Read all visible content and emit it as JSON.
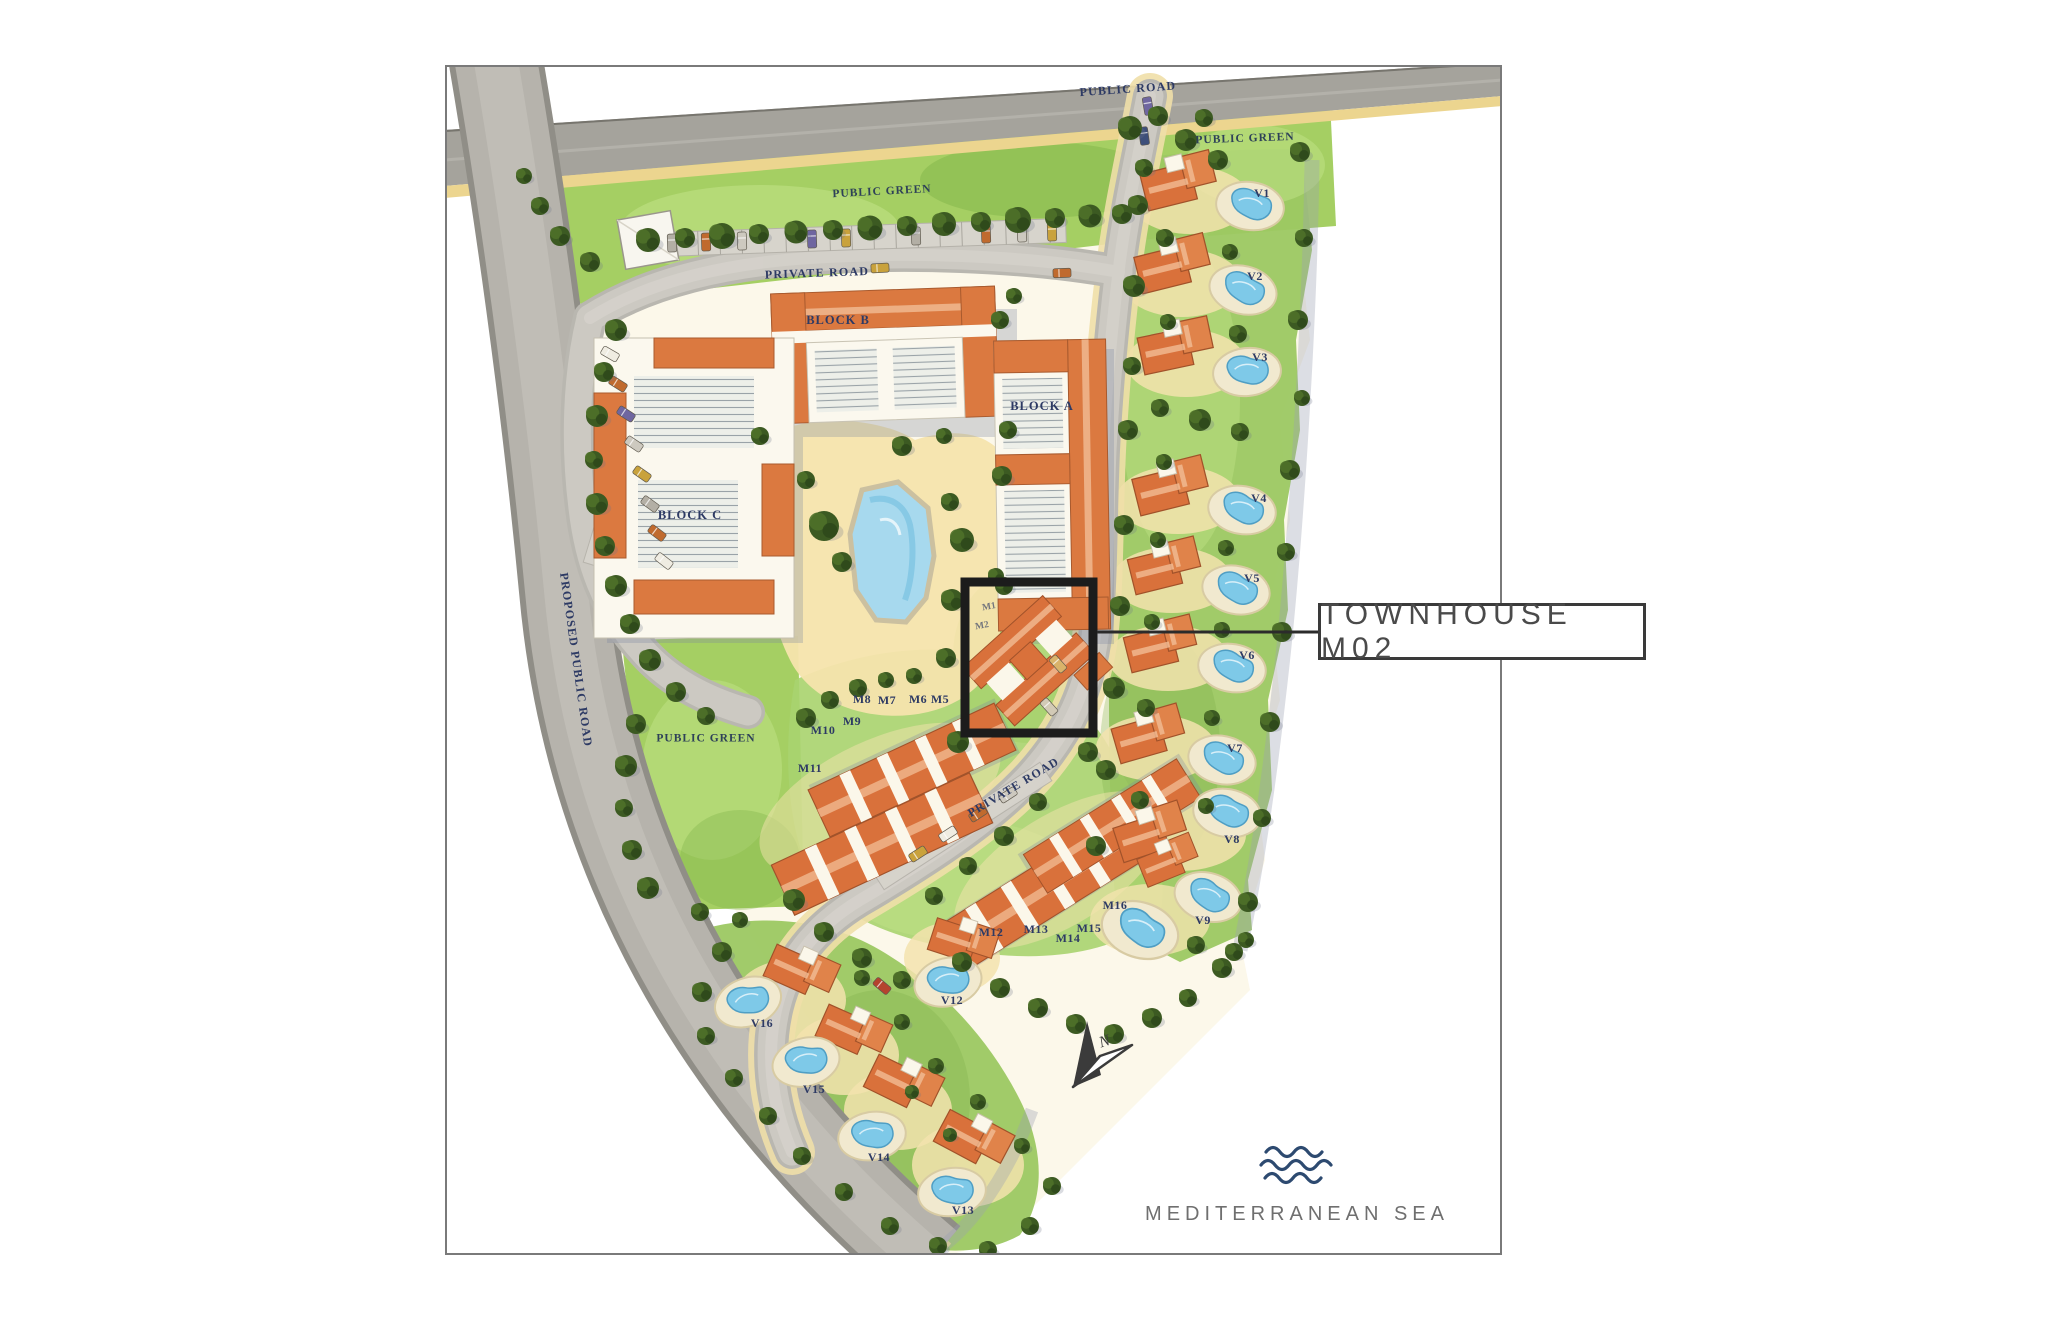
{
  "page": {
    "background": "#ffffff",
    "frame_color": "#7a7a7a"
  },
  "callout": {
    "label": "TOWNHOUSE M02",
    "border_color": "#3a3a3a",
    "text_color": "#4a4a4a",
    "highlight_square_color": "#1c1c1c"
  },
  "sea": {
    "label": "MEDITERRANEAN SEA",
    "text_color": "#6f6f6f",
    "wave_color": "#2d4a70"
  },
  "north": {
    "label": "N"
  },
  "palette": {
    "ink_label": "#2d3a64",
    "roof_orange": "#d9713b",
    "pool_blue": "#7ec9e8",
    "road_gray": "#b6b3ac",
    "green": "#a5cf63",
    "sand": "#f0d894"
  },
  "map_labels": [
    {
      "id": "public-road",
      "text": "PUBLIC ROAD",
      "x": 1128,
      "y": 90,
      "r": -4,
      "c": "road"
    },
    {
      "id": "public-green-top",
      "text": "PUBLIC GREEN",
      "x": 882,
      "y": 192,
      "r": -3,
      "c": "green"
    },
    {
      "id": "public-green-ne",
      "text": "PUBLIC GREEN",
      "x": 1245,
      "y": 139,
      "r": -2,
      "c": "green"
    },
    {
      "id": "private-road-top",
      "text": "PRIVATE ROAD",
      "x": 817,
      "y": 274,
      "r": -2,
      "c": "road"
    },
    {
      "id": "proposed-public-road",
      "text": "PROPOSED PUBLIC ROAD",
      "x": 575,
      "y": 660,
      "r": 82,
      "c": "road"
    },
    {
      "id": "public-green-west",
      "text": "PUBLIC GREEN",
      "x": 706,
      "y": 739,
      "r": 0,
      "c": "green"
    },
    {
      "id": "block-b",
      "text": "BLOCK B",
      "x": 838,
      "y": 321,
      "r": 0,
      "c": "block"
    },
    {
      "id": "block-a",
      "text": "BLOCK A",
      "x": 1042,
      "y": 407,
      "r": 0,
      "c": "block"
    },
    {
      "id": "block-c",
      "text": "BLOCK C",
      "x": 690,
      "y": 516,
      "r": 0,
      "c": "block"
    },
    {
      "id": "private-road-se",
      "text": "PRIVATE ROAD",
      "x": 1014,
      "y": 788,
      "r": -31,
      "c": "road"
    },
    {
      "id": "m1",
      "text": "M1",
      "x": 989,
      "y": 607,
      "r": -10,
      "c": "unitsm"
    },
    {
      "id": "m2",
      "text": "M2",
      "x": 982,
      "y": 626,
      "r": -10,
      "c": "unitsm"
    },
    {
      "id": "m5",
      "text": "M5",
      "x": 940,
      "y": 700,
      "r": 0,
      "c": "unit"
    },
    {
      "id": "m6",
      "text": "M6",
      "x": 918,
      "y": 700,
      "r": 0,
      "c": "unit"
    },
    {
      "id": "m7",
      "text": "M7",
      "x": 887,
      "y": 701,
      "r": 0,
      "c": "unit"
    },
    {
      "id": "m8",
      "text": "M8",
      "x": 862,
      "y": 700,
      "r": 0,
      "c": "unit"
    },
    {
      "id": "m9",
      "text": "M9",
      "x": 852,
      "y": 722,
      "r": 0,
      "c": "unit"
    },
    {
      "id": "m10",
      "text": "M10",
      "x": 823,
      "y": 731,
      "r": 0,
      "c": "unit"
    },
    {
      "id": "m11",
      "text": "M11",
      "x": 810,
      "y": 769,
      "r": 0,
      "c": "unit"
    },
    {
      "id": "m12",
      "text": "M12",
      "x": 991,
      "y": 933,
      "r": 0,
      "c": "unit"
    },
    {
      "id": "m13",
      "text": "M13",
      "x": 1036,
      "y": 930,
      "r": 0,
      "c": "unit"
    },
    {
      "id": "m14",
      "text": "M14",
      "x": 1068,
      "y": 939,
      "r": 0,
      "c": "unit"
    },
    {
      "id": "m15",
      "text": "M15",
      "x": 1089,
      "y": 929,
      "r": 0,
      "c": "unit"
    },
    {
      "id": "m16",
      "text": "M16",
      "x": 1115,
      "y": 906,
      "r": 0,
      "c": "unit"
    },
    {
      "id": "v1",
      "text": "V1",
      "x": 1262,
      "y": 194,
      "r": 0,
      "c": "unit"
    },
    {
      "id": "v2",
      "text": "V2",
      "x": 1255,
      "y": 277,
      "r": 0,
      "c": "unit"
    },
    {
      "id": "v3",
      "text": "V3",
      "x": 1260,
      "y": 358,
      "r": 0,
      "c": "unit"
    },
    {
      "id": "v4",
      "text": "V4",
      "x": 1259,
      "y": 499,
      "r": 0,
      "c": "unit"
    },
    {
      "id": "v5",
      "text": "V5",
      "x": 1252,
      "y": 579,
      "r": 0,
      "c": "unit"
    },
    {
      "id": "v6",
      "text": "V6",
      "x": 1247,
      "y": 656,
      "r": 0,
      "c": "unit"
    },
    {
      "id": "v7",
      "text": "V7",
      "x": 1235,
      "y": 749,
      "r": 0,
      "c": "unit"
    },
    {
      "id": "v8",
      "text": "V8",
      "x": 1232,
      "y": 840,
      "r": 0,
      "c": "unit"
    },
    {
      "id": "v9",
      "text": "V9",
      "x": 1203,
      "y": 921,
      "r": 0,
      "c": "unit"
    },
    {
      "id": "v12",
      "text": "V12",
      "x": 952,
      "y": 1001,
      "r": 0,
      "c": "unit"
    },
    {
      "id": "v13",
      "text": "V13",
      "x": 963,
      "y": 1211,
      "r": 0,
      "c": "unit"
    },
    {
      "id": "v14",
      "text": "V14",
      "x": 879,
      "y": 1158,
      "r": 0,
      "c": "unit"
    },
    {
      "id": "v15",
      "text": "V15",
      "x": 814,
      "y": 1090,
      "r": 0,
      "c": "unit"
    },
    {
      "id": "v16",
      "text": "V16",
      "x": 762,
      "y": 1024,
      "r": 0,
      "c": "unit"
    }
  ]
}
